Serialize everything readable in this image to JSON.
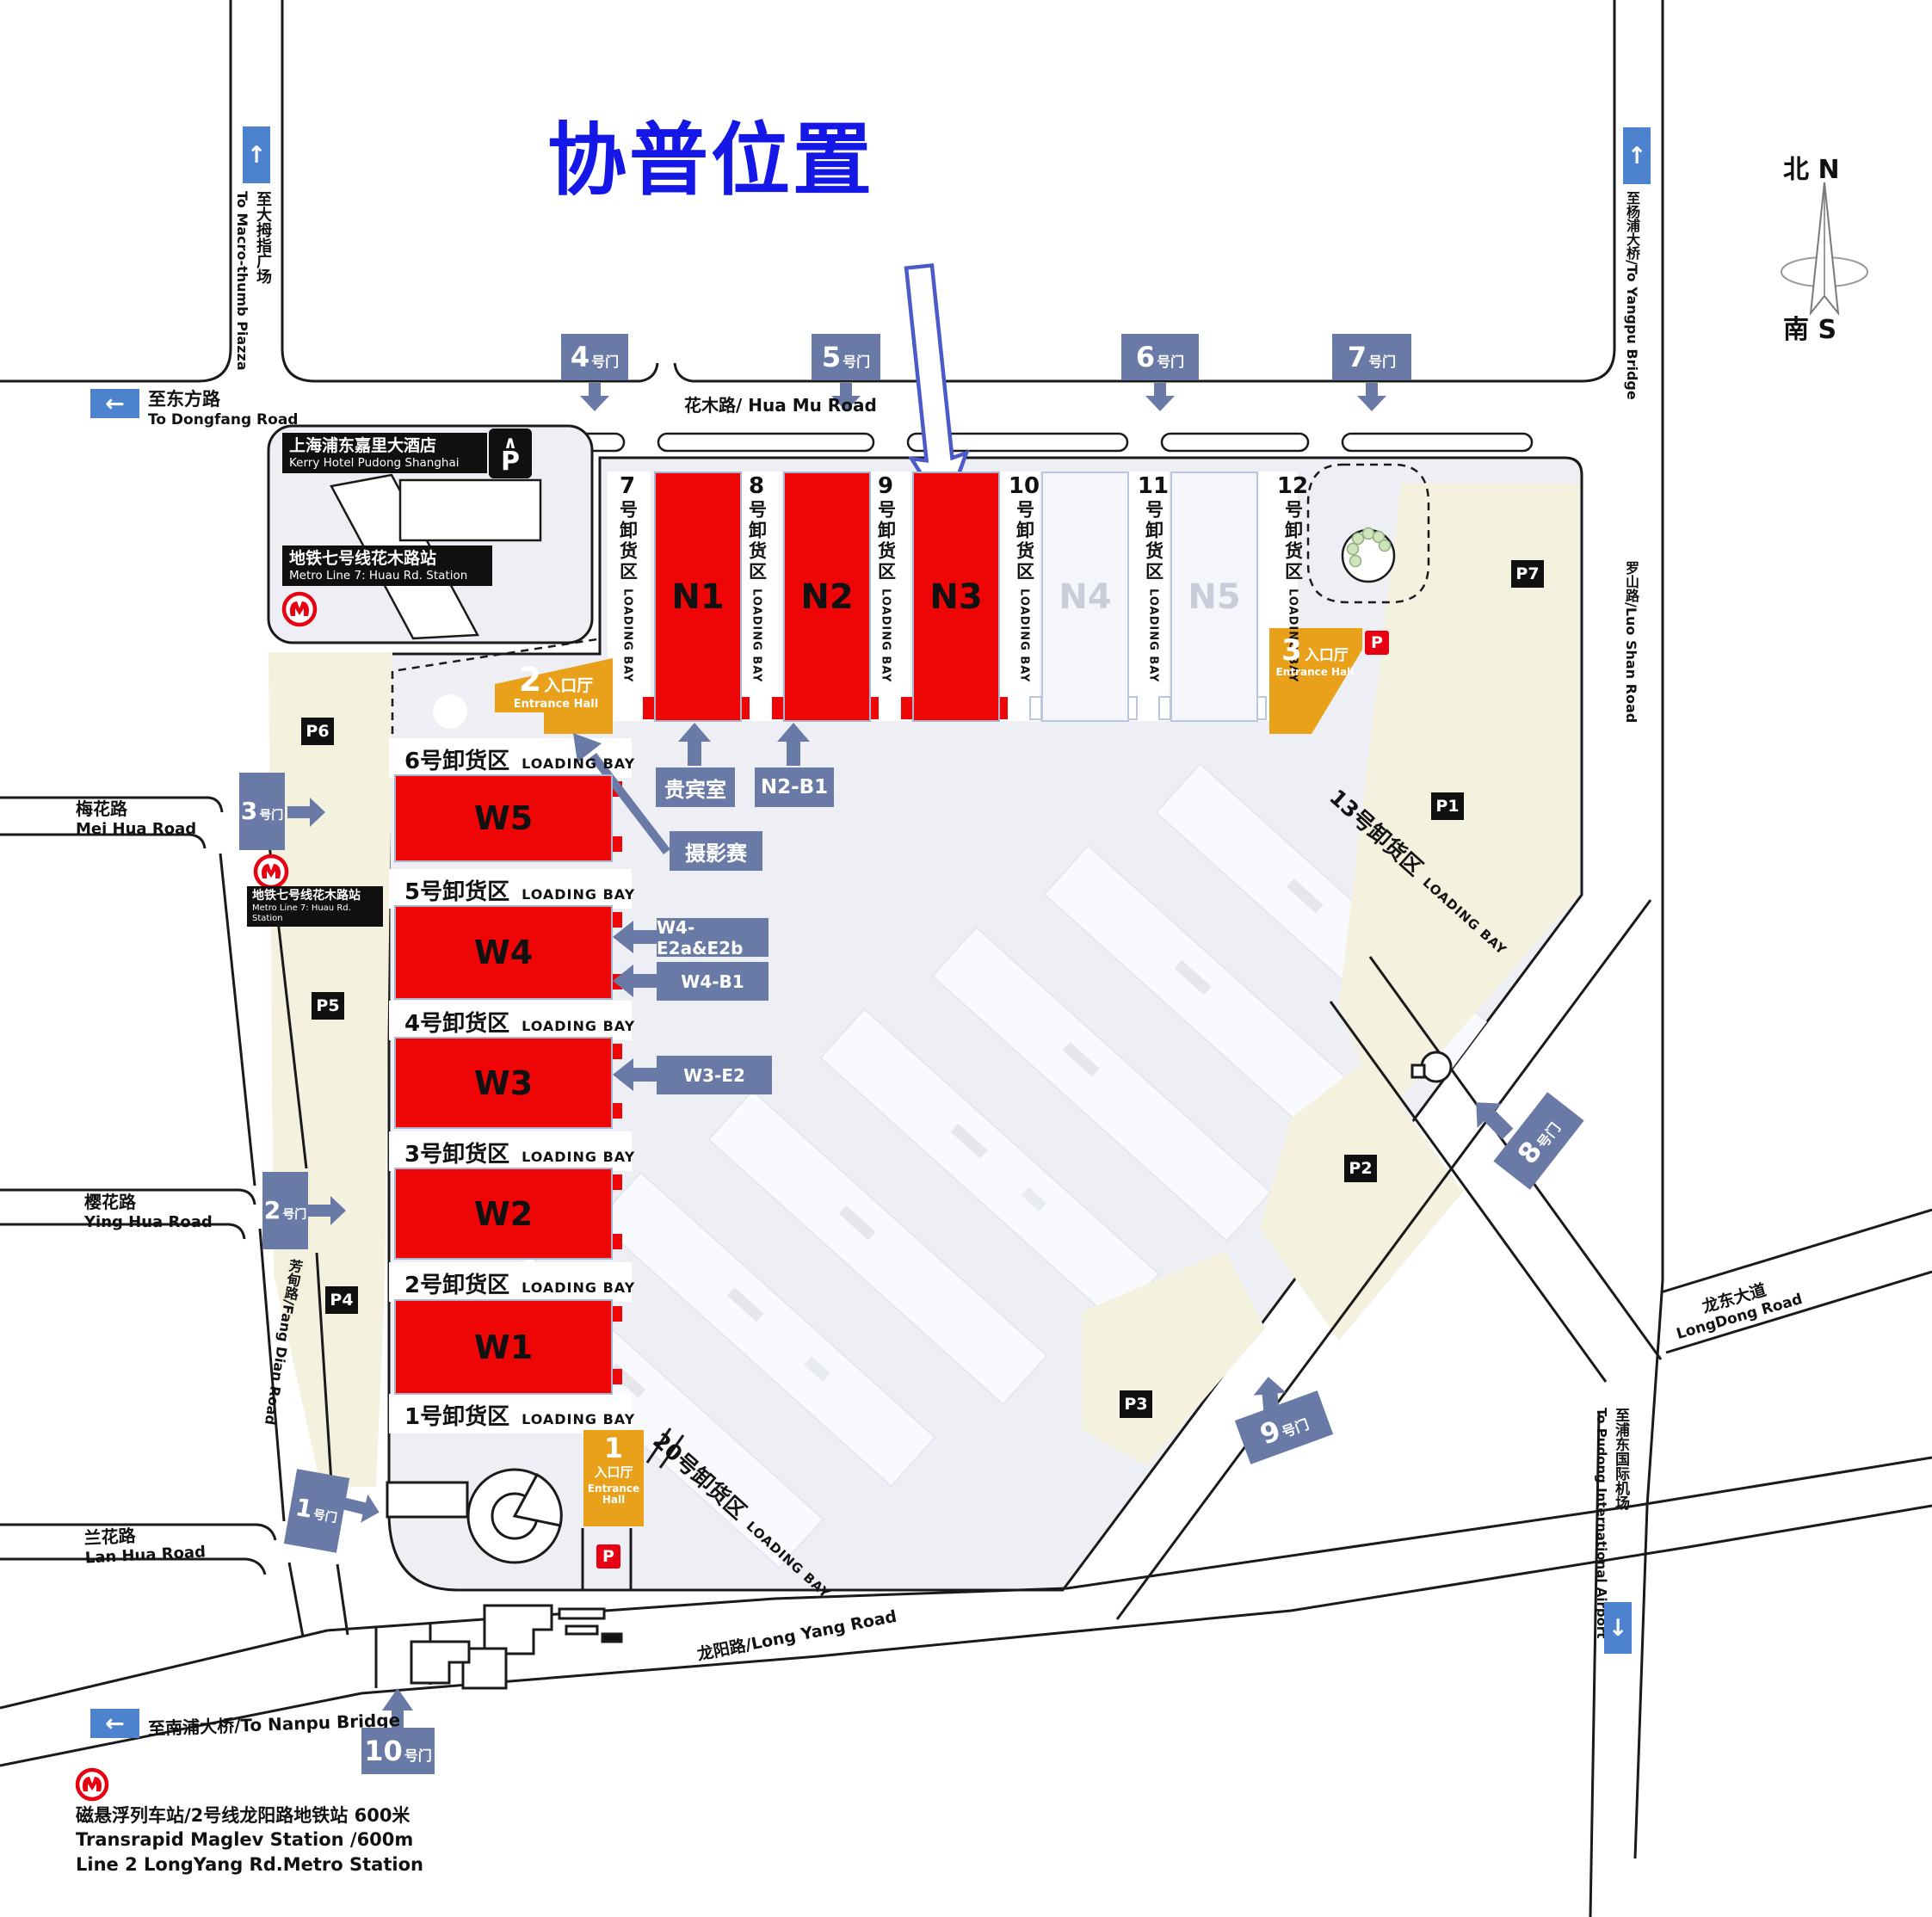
{
  "title": "协普位置",
  "compass": {
    "north": "北 N",
    "south": "南 S"
  },
  "icons": {
    "arrow_up": "↑",
    "arrow_left": "←",
    "arrow_down": "↓",
    "parking_roof": "∧"
  },
  "signs": {
    "macro_thumb": {
      "cn": "至大拇指广场",
      "en": "To Macro-thumb Piazza"
    },
    "dongfang": {
      "cn": "至东方路",
      "en": "To Dongfang Road"
    },
    "yangpu": {
      "text": "至杨浦大桥/To Yangpu Bridge"
    },
    "nanpu": {
      "text": "至南浦大桥/To Nanpu Bridge"
    },
    "airport": {
      "cn": "至浦东国际机场",
      "en": "To Pudong International Airport"
    }
  },
  "roads": {
    "huamu": "花木路/ Hua Mu Road",
    "meihua_cn": "梅花路",
    "meihua_en": "Mei Hua Road",
    "yinghua_cn": "樱花路",
    "yinghua_en": "Ying Hua Road",
    "lanhua_cn": "兰花路",
    "lanhua_en": "Lan Hua Road",
    "fangdian": "芳甸路/Fang Dian Road",
    "longyang": "龙阳路/Long Yang Road",
    "longdong_cn": "龙东大道",
    "longdong_en": "LongDong Road",
    "luoshan": "罗山路/Luo Shan Road"
  },
  "landmarks": {
    "kerry_cn": "上海浦东嘉里大酒店",
    "kerry_en": "Kerry Hotel Pudong Shanghai",
    "metro7_cn": "地铁七号线花木路站",
    "metro7_en": "Metro Line 7: Huau Rd. Station",
    "maglev_l1": "磁悬浮列车站/2号线龙阳路地铁站  600米",
    "maglev_l2": "Transrapid Maglev Station  /600m",
    "maglev_l3": "Line 2 LongYang Rd.Metro Station"
  },
  "halls": {
    "north": [
      "N1",
      "N2",
      "N3",
      "N4",
      "N5"
    ],
    "west": [
      "W5",
      "W4",
      "W3",
      "W2",
      "W1"
    ]
  },
  "loading_bays": {
    "en": "LOADING BAY",
    "suffix_cn": "号卸货区",
    "west": [
      "6号卸货区",
      "5号卸货区",
      "4号卸货区",
      "3号卸货区",
      "2号卸货区",
      "1号卸货区"
    ],
    "north": [
      "7",
      "8",
      "9",
      "10",
      "11",
      "12"
    ],
    "diag": [
      "13号卸货区",
      "20号卸货区"
    ]
  },
  "gates": [
    {
      "num": "1",
      "suffix": "号门"
    },
    {
      "num": "2",
      "suffix": "号门"
    },
    {
      "num": "3",
      "suffix": "号门"
    },
    {
      "num": "4",
      "suffix": "号门"
    },
    {
      "num": "5",
      "suffix": "号门"
    },
    {
      "num": "6",
      "suffix": "号门"
    },
    {
      "num": "7",
      "suffix": "号门"
    },
    {
      "num": "8",
      "suffix": "号门"
    },
    {
      "num": "9",
      "suffix": "号门"
    },
    {
      "num": "10",
      "suffix": "号门"
    }
  ],
  "entrances": [
    {
      "num": "1",
      "cn": "入口厅",
      "en": "Entrance Hall"
    },
    {
      "num": "2",
      "cn": "入口厅",
      "en": "Entrance Hall"
    },
    {
      "num": "3",
      "cn": "入口厅",
      "en": "Entrance Hall"
    }
  ],
  "parking": {
    "labels": [
      "P1",
      "P2",
      "P3",
      "P4",
      "P5",
      "P6",
      "P7"
    ],
    "p": "P"
  },
  "callouts": {
    "vip": "贵宾室",
    "n2b1": "N2-B1",
    "photo": "摄影赛",
    "w4e": "W4-E2a&E2b",
    "w4b1": "W4-B1",
    "w3e2": "W3-E2"
  }
}
